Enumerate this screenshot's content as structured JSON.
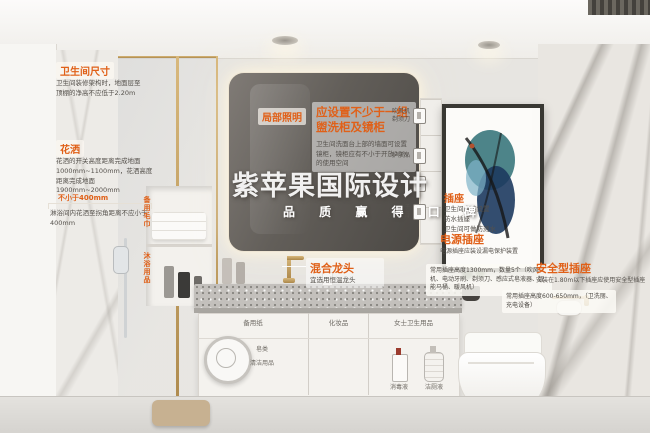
{
  "accent": "#e06018",
  "watermark": {
    "title": "紫苹果国际设计",
    "subtitle": "品 质 赢 得 口 碑"
  },
  "annotations": {
    "size": {
      "title": "卫生间尺寸",
      "body": "卫生间装修架构时，地面层至顶棚的净高不应低于2.20m"
    },
    "shower": {
      "title": "花洒",
      "body": "花洒的开关高度距离完成地面1000mm~1100mm，花洒高度距离完成地面1900mm~2000mm"
    },
    "shower_dim": {
      "dim": "不小于400mm",
      "body": "淋浴间内花洒至拐角距离不应小于400mm"
    },
    "local_light": {
      "title": "局部照明"
    },
    "mirror_cabinet": {
      "title": "应设置不少于一组盥洗柜及镜柜",
      "body": "卫生间洗面台上部的墙面可设置镜柜，镜柜应有不小于开放20%的使用空间"
    },
    "niche_top": "备用毛巾",
    "niche_bottom": "沐浴用品",
    "shelf_items": [
      {
        "label": "吹风机\n剃须刀"
      },
      {
        "label": "护肤品"
      },
      {
        "label": "化妆品\n护肤水"
      },
      {
        "label": "杯子\n牙刷牙膏"
      }
    ],
    "socket": {
      "title": "插座",
      "body": "卫生间应该设置\n防水插座\n卫生间可做防溅水"
    },
    "power_socket": {
      "title": "电源插座",
      "body": "电源插座应装设漏电保护装置"
    },
    "mixer": {
      "title": "混合龙头",
      "body": "宜选用恒温龙头"
    },
    "socket_note_high": "常用插座高度1300mm，数量5个（吹风机、电动牙刷、剃须刀、感应式皂液器、智能马桶、暖风机）",
    "safe_socket": {
      "title": "安全型插座",
      "body": "安装在1.80m以下插座应使用安全型插座"
    },
    "socket_note_low": "常用插座高度600-650mm，（卫洗丽、充电设备）"
  },
  "cabinet": {
    "drawers": [
      "备用纸",
      "化妆品",
      "女士卫生用品"
    ],
    "shelf_left": [
      "皂类",
      "清洁用品"
    ],
    "shelf_right": [
      "消毒液",
      "洁厕液"
    ]
  }
}
